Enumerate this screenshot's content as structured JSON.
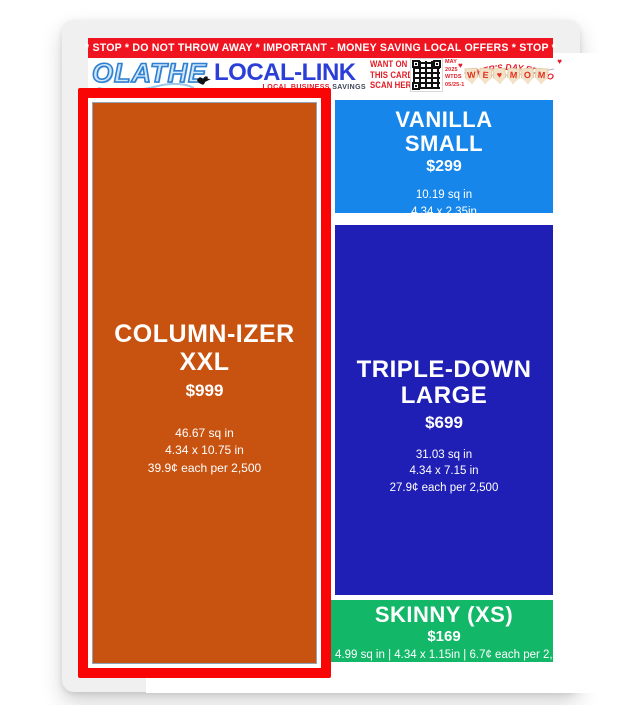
{
  "banner": {
    "text": "* STOP * DO NOT THROW AWAY * IMPORTANT - MONEY SAVING LOCAL OFFERS * STOP *"
  },
  "header": {
    "brand_primary": "OLATHE",
    "brand_secondary": "LOCAL-LINK",
    "tagline_hidden": "LOCAL BUSINESS ",
    "tagline_visible": "SAVINGS",
    "scan_cta": "WANT ON\nTHIS CARD?\nSCAN HERE!",
    "issue": "MAY\n2025\nWTDS\n05/25-1",
    "edition_arc": "MOTHER'S DAY EDITION",
    "pennant_letters": [
      "W",
      "E",
      "♥",
      "M",
      "O",
      "M"
    ],
    "mini_heart": "♥"
  },
  "ads": {
    "columnizer": {
      "name": "COLUMN-IZER\nXXL",
      "price": "$999",
      "details": "46.67 sq in\n4.34 x 10.75 in\n39.9¢ each per 2,500",
      "selected": true,
      "color": "#c85311"
    },
    "vanilla": {
      "name": "VANILLA\nSMALL",
      "price": "$299",
      "details": "10.19 sq in\n4.34 x 2.35in\n11.9¢ each per 2,500",
      "selected": false,
      "color": "#1786ea"
    },
    "triple": {
      "name": "TRIPLE-DOWN\nLARGE",
      "price": "$699",
      "details": "31.03 sq in\n4.34 x 7.15 in\n27.9¢ each per 2,500",
      "selected": false,
      "color": "#1f1eb5"
    },
    "skinny": {
      "name": "SKINNY (XS)",
      "price": "$169",
      "details": "4.99 sq in | 4.34 x 1.15in | 6.7¢ each per 2,500",
      "selected": false,
      "color": "#12b768"
    }
  },
  "colors": {
    "banner_red": "#ef1420",
    "selection_red": "#fa0505",
    "brand_blue": "#2b3ed8",
    "card_edge_gray": "#f0f0f1",
    "pennant_tan": "#f3e2c8"
  }
}
